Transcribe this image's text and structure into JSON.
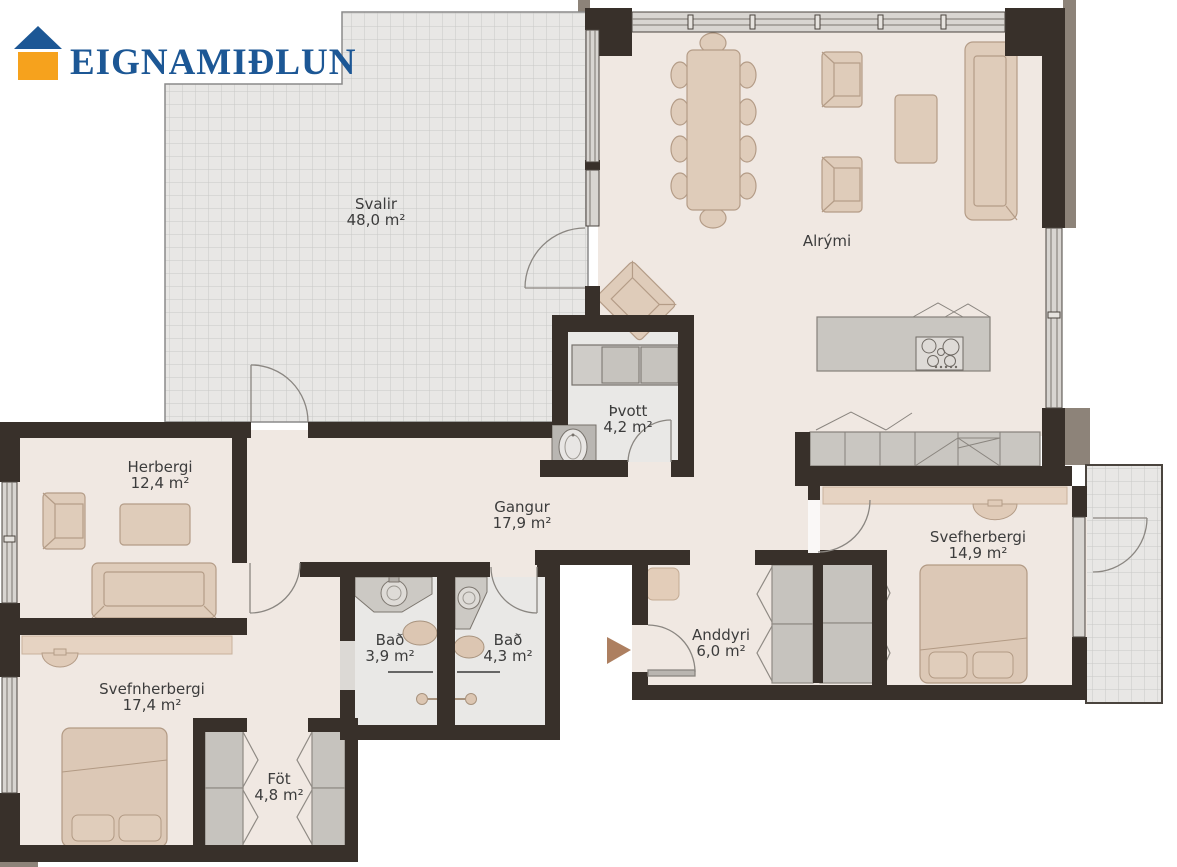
{
  "logo": {
    "brand": "EIGNAMIÐLUN",
    "icon": "house-icon",
    "colors": {
      "roof_blue": "#1c5795",
      "base_orange": "#f6a21d",
      "text_blue": "#1c5795"
    }
  },
  "floorplan": {
    "rooms": [
      {
        "id": "svalir",
        "name": "Svalir",
        "area": "48,0 m²"
      },
      {
        "id": "alrymi",
        "name": "Alrými",
        "area": ""
      },
      {
        "id": "herbergi",
        "name": "Herbergi",
        "area": "12,4 m²"
      },
      {
        "id": "thvott",
        "name": "Þvott",
        "area": "4,2 m²"
      },
      {
        "id": "gangur",
        "name": "Gangur",
        "area": "17,9 m²"
      },
      {
        "id": "svefherbergi-right",
        "name": "Svefherbergi",
        "area": "14,9 m²"
      },
      {
        "id": "bad-1",
        "name": "Bað",
        "area": "3,9 m²"
      },
      {
        "id": "bad-2",
        "name": "Bað",
        "area": "4,3 m²"
      },
      {
        "id": "anddyri",
        "name": "Anddyri",
        "area": "6,0 m²"
      },
      {
        "id": "svefnherbergi-left",
        "name": "Svefnherbergi",
        "area": "17,4 m²"
      },
      {
        "id": "fot",
        "name": "Föt",
        "area": "4,8 m²"
      }
    ],
    "palette": {
      "wall": "#38302a",
      "wall_trim": "#8d8379",
      "floor": "#f0e8e2",
      "floor_wet": "#e9e8e6",
      "tile_bg": "#e8e7e5",
      "tile_line": "#c9c8c6",
      "furniture_beige": "#dfccba",
      "furniture_beige_stroke": "#b49c87",
      "furniture_gray": "#c9c6c1",
      "furniture_gray_stroke": "#85807a",
      "window_fill": "#d8d5d1",
      "door_stroke": "#8a8681",
      "entry_arrow": "#ad7f60"
    }
  }
}
